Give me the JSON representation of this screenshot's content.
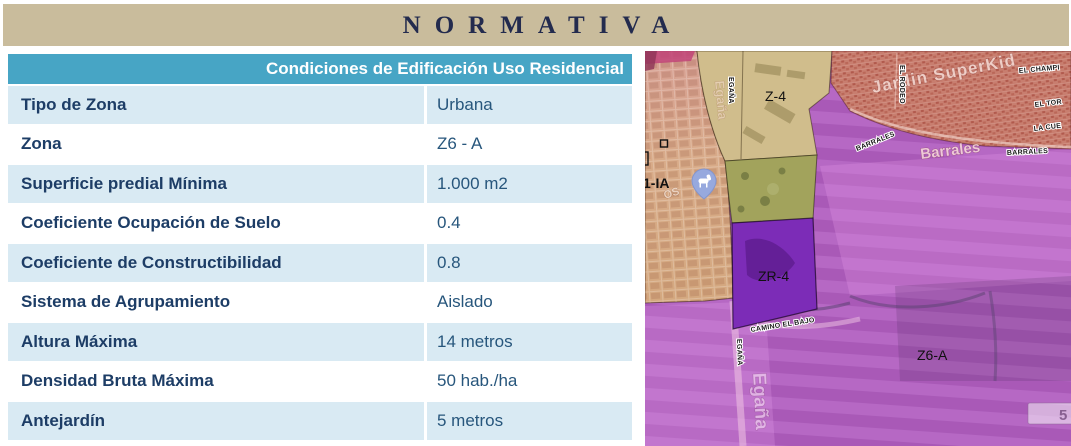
{
  "banner": {
    "title": "NORMATIVA"
  },
  "table": {
    "header": "Condiciones de Edificación Uso Residencial",
    "rows": [
      {
        "label": "Tipo de Zona",
        "value": "Urbana"
      },
      {
        "label": "Zona",
        "value": "Z6 - A"
      },
      {
        "label": "Superficie predial Mínima",
        "value": "1.000 m2"
      },
      {
        "label": "Coeficiente Ocupación de Suelo",
        "value": "0.4"
      },
      {
        "label": "Coeficiente de Constructibilidad",
        "value": "0.8"
      },
      {
        "label": "Sistema de Agrupamiento",
        "value": "Aislado"
      },
      {
        "label": "Altura Máxima",
        "value": "14 metros"
      },
      {
        "label": "Densidad Bruta Máxima",
        "value": "50 hab./ha"
      },
      {
        "label": "Antejardín",
        "value": "5 metros"
      }
    ]
  },
  "map": {
    "zone_labels": {
      "z4": "Z-4",
      "z1ia": "1-IA",
      "zr4": "ZR-4",
      "z6a": "Z6-A"
    },
    "street_labels": {
      "egana_top": "EGAÑA",
      "el_rodeo": "EL RODEO",
      "barrales_small_1": "BARRALES",
      "barrales_big": "Barrales",
      "barrales_small_2": "BARRALES",
      "el_champi": "EL CHAMPI",
      "el_tor": "EL TOR",
      "la_cue": "LA CUE",
      "camino_el_bajo": "CAMINO EL BAJO",
      "egana_mid": "EGAÑA",
      "egana_big": "Egaña",
      "egana_faded": "Egaña"
    },
    "place_labels": {
      "jardin_superkid": "Jardin SuperKid",
      "os_fragment": "OS"
    },
    "road_shield": "5",
    "colors": {
      "banner_bg": "#c9bc9c",
      "title_text": "#232b4e",
      "table_header_bg": "#47a5c5",
      "row_alt_bg": "#d9eaf3",
      "label_text": "#1d3d66",
      "value_text": "#27567c",
      "zone_residential_red": "#c87e6f",
      "zone_urban_rose": "#d79f93",
      "zone_z4_tan": "#d0bd8c",
      "zone_olive": "#a2a35c",
      "zone_zr4_purple": "#7c2cb7",
      "zone_z6a_purple": "#b15fc0",
      "pin_blue": "#97a9de"
    }
  }
}
